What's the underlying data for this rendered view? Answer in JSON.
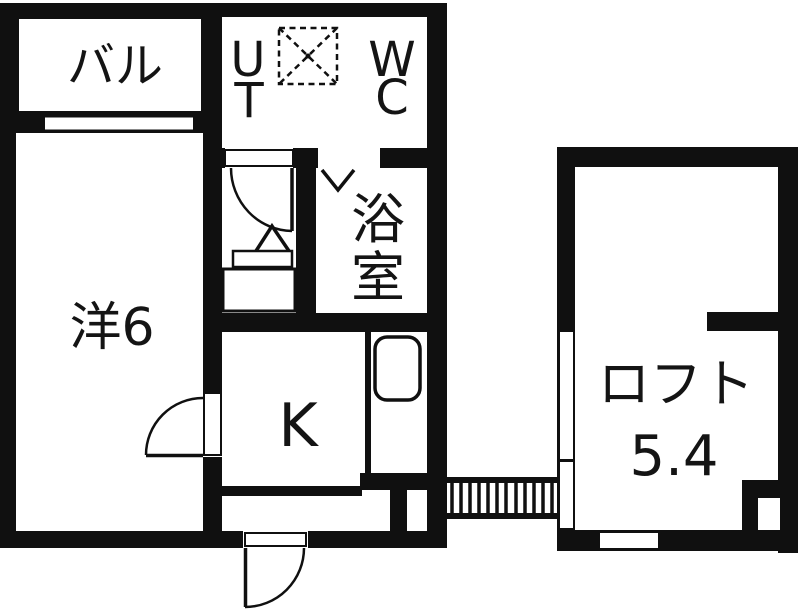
{
  "plan": {
    "type_note": "apartment floor plan",
    "balcony_label": "バル",
    "western_room_label": "洋6",
    "utility_label_top": "U",
    "utility_label_bottom": "T",
    "wc_label_top": "W",
    "wc_label_bottom": "C",
    "bathroom_label_top": "浴",
    "bathroom_label_bottom": "室",
    "kitchen_label": "K",
    "loft_label": "ロフト",
    "loft_size_label": "5.4"
  },
  "colors": {
    "wall": "#101010",
    "background": "#ffffff",
    "text": "#141414"
  }
}
